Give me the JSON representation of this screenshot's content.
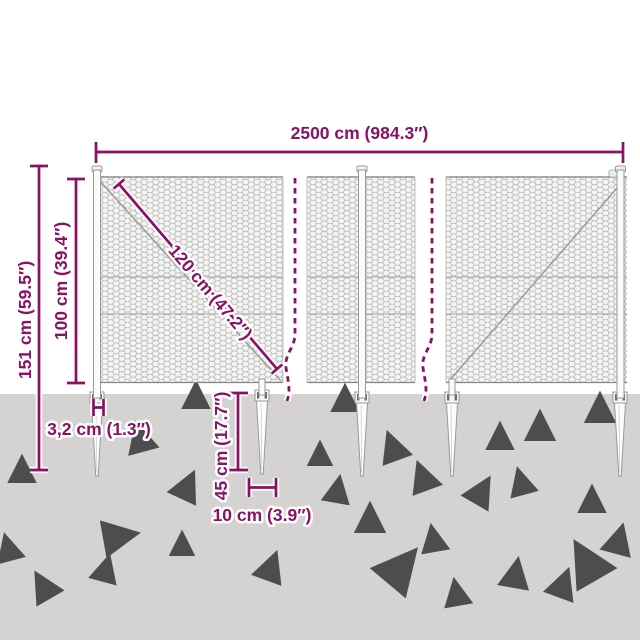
{
  "colors": {
    "dimension_accent": "#8a1164",
    "ground": "#d4d3d1",
    "mesh_wire": "#b6b6b6",
    "frame_gray": "#848484"
  },
  "diagram": {
    "labels": {
      "total_width": "2500 cm (984.3″)",
      "total_height": "151 cm (59.5″)",
      "fence_height": "100 cm (39.4″)",
      "mesh_diagonal": "120 cm (47.2″)",
      "post_width": "3,2 cm (1.3″)",
      "spike_length": "45 cm (17.7″)",
      "spike_width": "10 cm (3.9″)"
    }
  }
}
